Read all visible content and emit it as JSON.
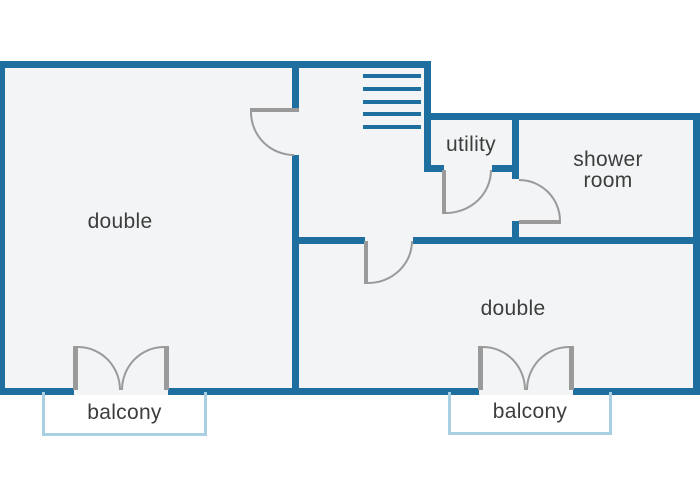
{
  "diagram_type": "floor-plan",
  "colors": {
    "wall": "#1e6f9f",
    "door": "#9a9a9a",
    "floor": "#f2f4f5",
    "balcony_outline": "#a9cfe2",
    "label_text": "#3d3d3d",
    "background": "#ffffff"
  },
  "rooms": {
    "double_left": {
      "label": "double"
    },
    "double_right": {
      "label": "double"
    },
    "utility": {
      "label": "utility"
    },
    "shower_room": {
      "label": "shower room"
    },
    "balcony_left": {
      "label": "balcony"
    },
    "balcony_right": {
      "label": "balcony"
    }
  }
}
